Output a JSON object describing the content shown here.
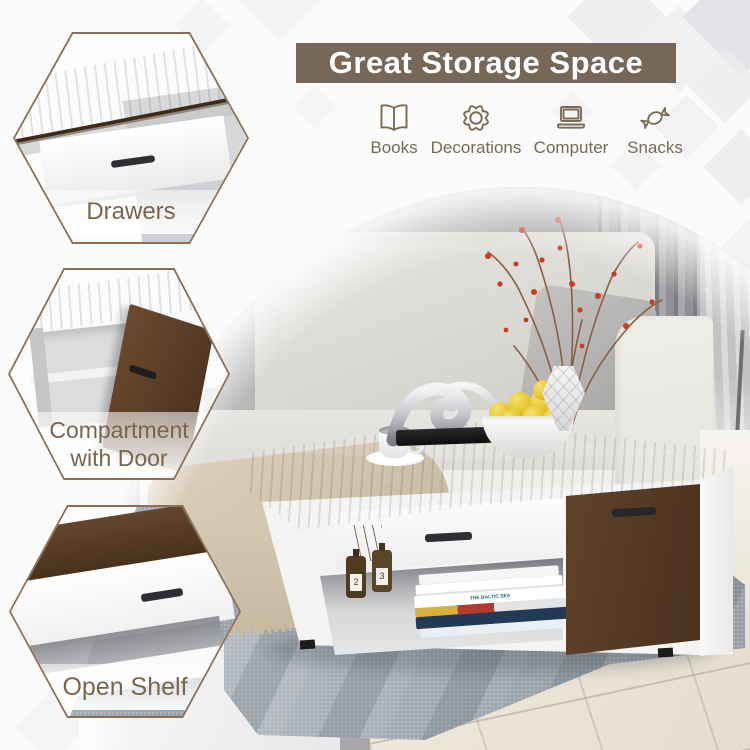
{
  "banner": {
    "title": "Great Storage Space"
  },
  "storage_items": [
    {
      "label": "Books",
      "icon": "open-book-icon"
    },
    {
      "label": "Decorations",
      "icon": "flower-icon"
    },
    {
      "label": "Computer",
      "icon": "laptop-icon"
    },
    {
      "label": "Snacks",
      "icon": "candy-icon"
    }
  ],
  "callouts": [
    {
      "label": "Drawers"
    },
    {
      "label": "Compartment with Door"
    },
    {
      "label": "Open Shelf"
    }
  ],
  "photo_details": {
    "book_spine_text": "THE BALTIC SEA",
    "bottle_labels": [
      "2",
      "3"
    ]
  },
  "colors": {
    "banner_bg": "#776759",
    "label_text": "#7b6a53",
    "hexagon_border": "#8a7056",
    "wood_dark": "#5d3f2a",
    "lemon_yellow": "#e9c832",
    "berry_red": "#cc3a20",
    "rug_gray": "#9fa8ae"
  }
}
